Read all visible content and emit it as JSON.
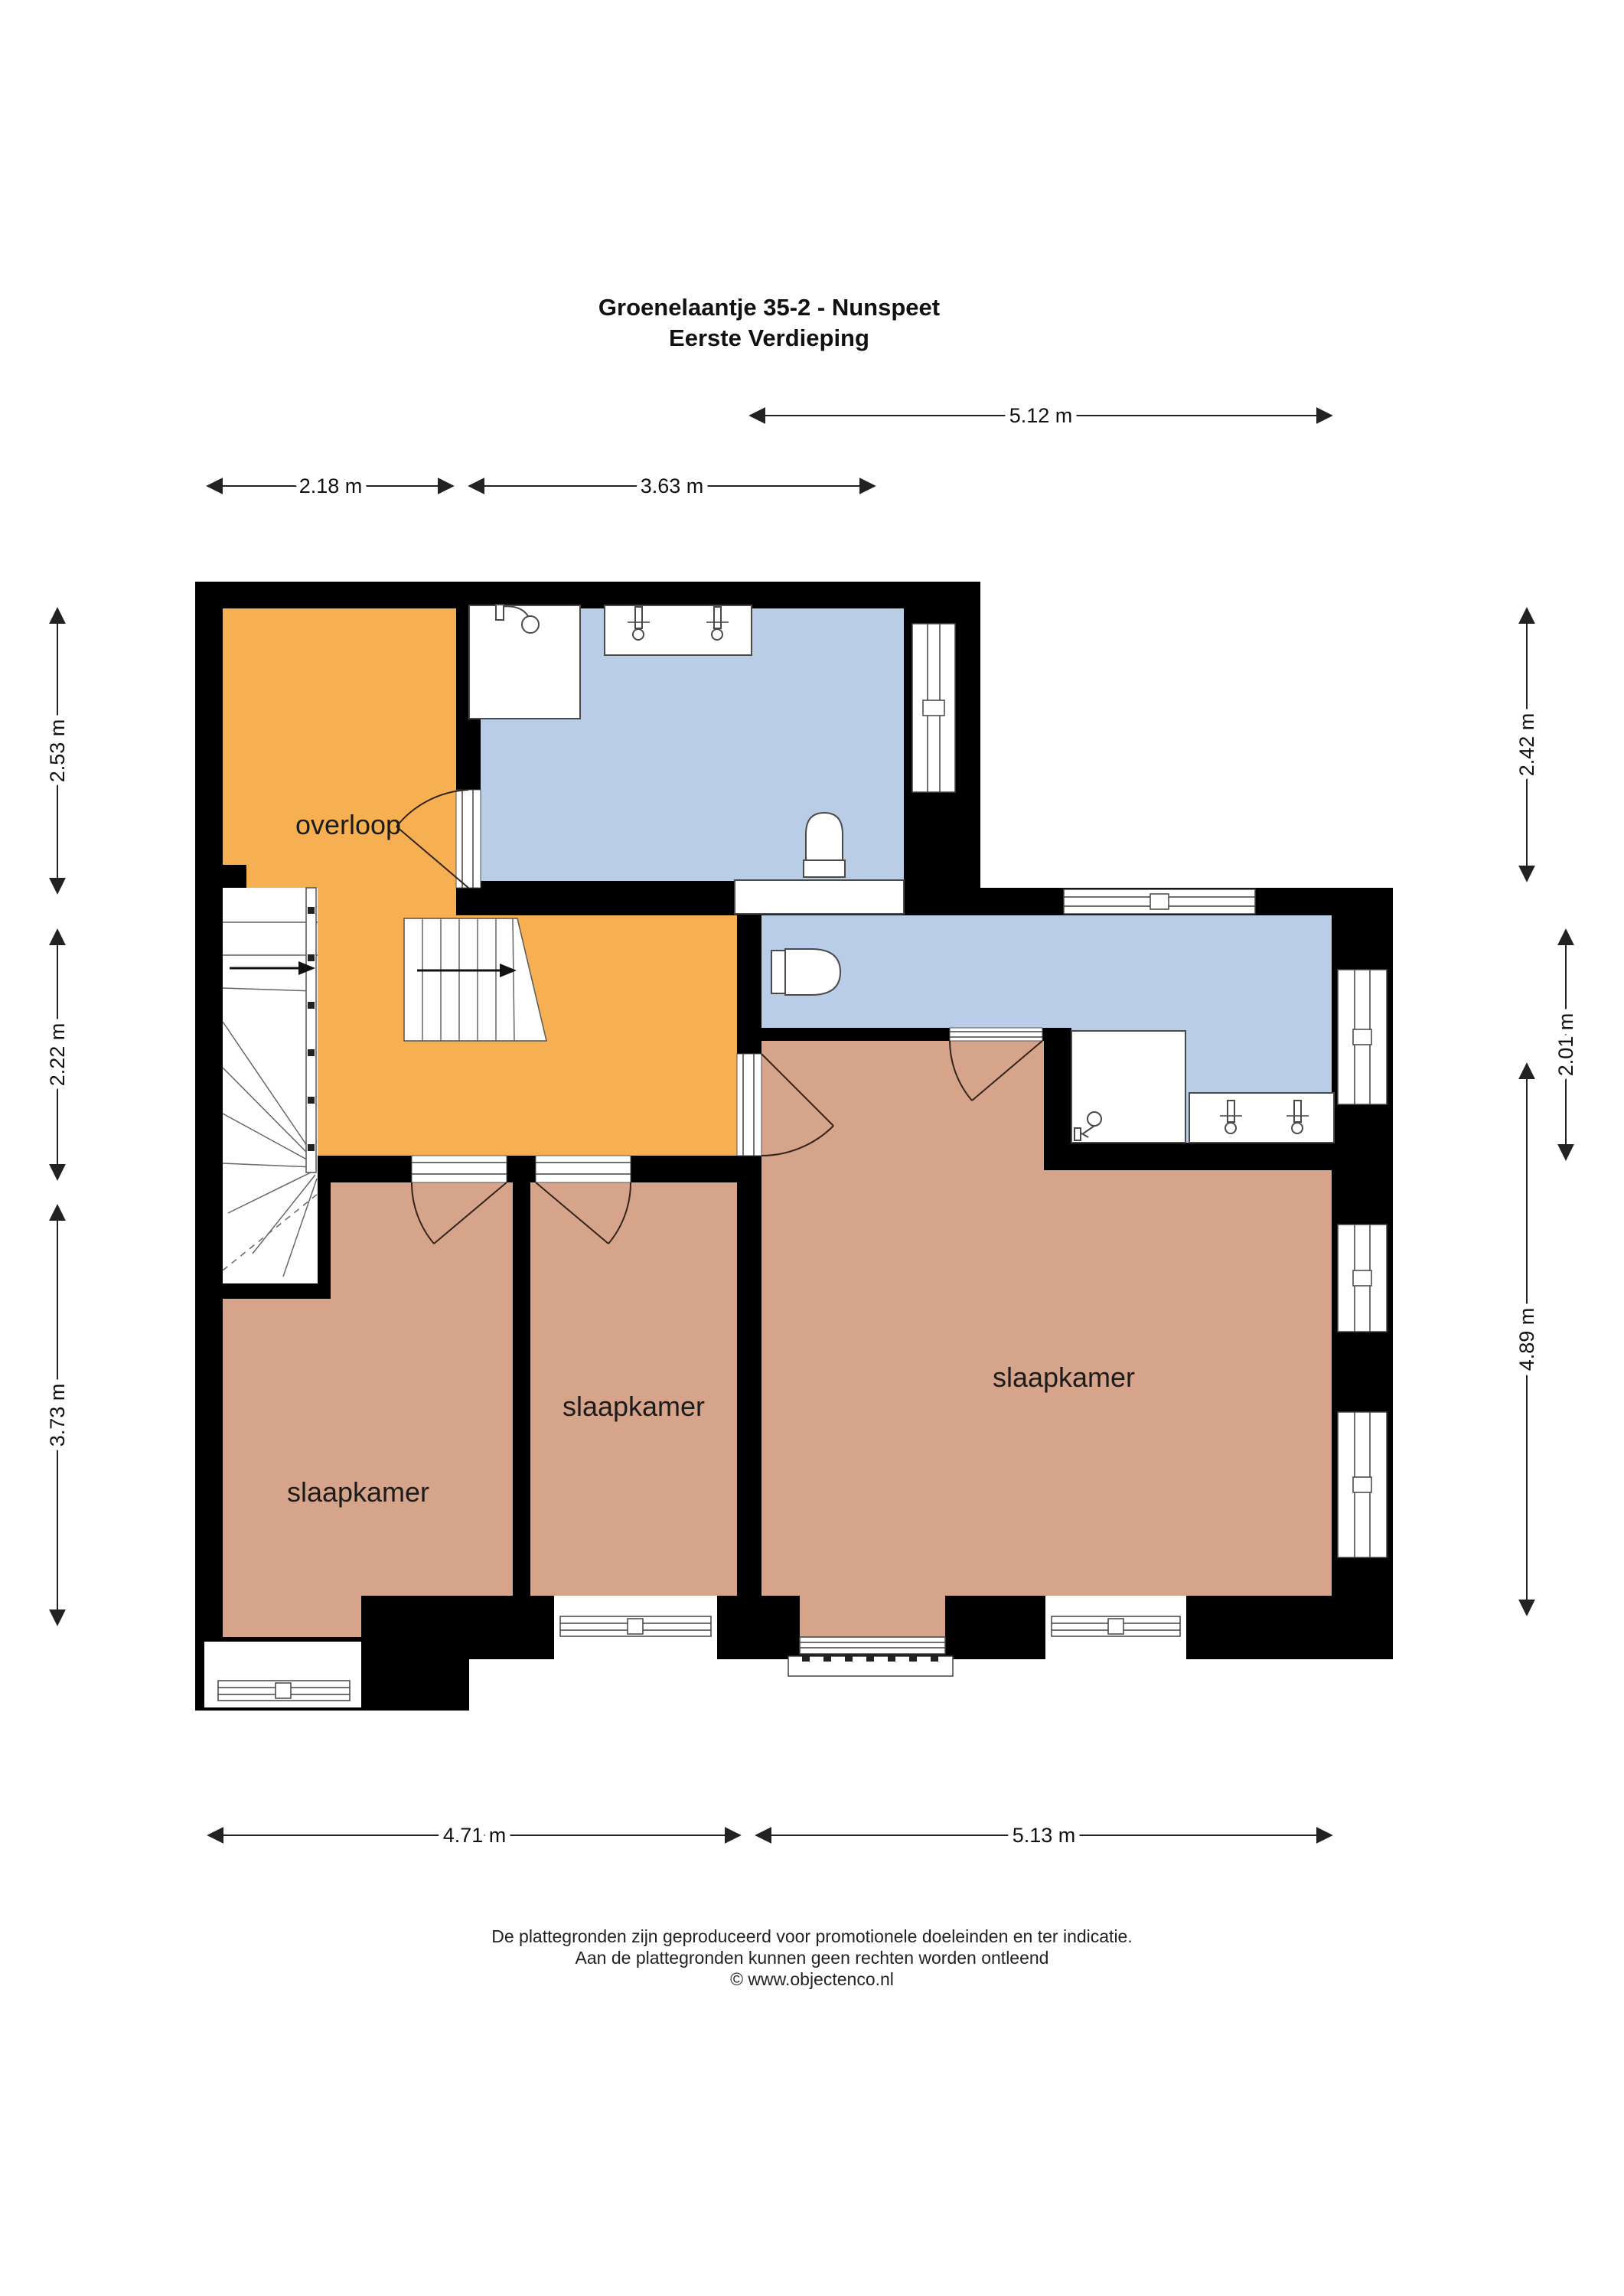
{
  "title": {
    "line1": "Groenelaantje 35-2 - Nunspeet",
    "line2": "Eerste Verdieping"
  },
  "rooms": {
    "landing": {
      "label": "overloop"
    },
    "bedroom_left": {
      "label": "slaapkamer"
    },
    "bedroom_middle": {
      "label": "slaapkamer"
    },
    "bedroom_right": {
      "label": "slaapkamer"
    }
  },
  "dimensions": {
    "top": [
      {
        "label": "5.12 m"
      }
    ],
    "top_left": [
      {
        "label": "2.18 m"
      },
      {
        "label": "3.63 m"
      }
    ],
    "left": [
      {
        "label": "2.53 m"
      },
      {
        "label": "2.22 m"
      },
      {
        "label": "3.73 m"
      }
    ],
    "right": [
      {
        "label": "2.42 m"
      },
      {
        "label": "2.01 m"
      },
      {
        "label": "4.89 m"
      }
    ],
    "bottom": [
      {
        "label": "4.71 m"
      },
      {
        "label": "5.13 m"
      }
    ]
  },
  "footer": {
    "line1": "De plattegronden zijn geproduceerd voor promotionele doeleinden en ter indicatie.",
    "line2": "Aan de plattegronden kunnen geen rechten worden ontleend",
    "line3": "© www.objectenco.nl"
  },
  "colors": {
    "landing": "#F6B052",
    "bathroom": "#B9CDE7",
    "bedroom": "#D5A48A",
    "wall": "#000000"
  },
  "icons": {
    "stairs_direction": "arrow-right-icon",
    "toilet": "toilet-icon",
    "shower": "shower-head-icon",
    "tap": "tap-icon",
    "railing": "railing-icon",
    "door": "door-swing-icon",
    "window": "window-icon"
  }
}
